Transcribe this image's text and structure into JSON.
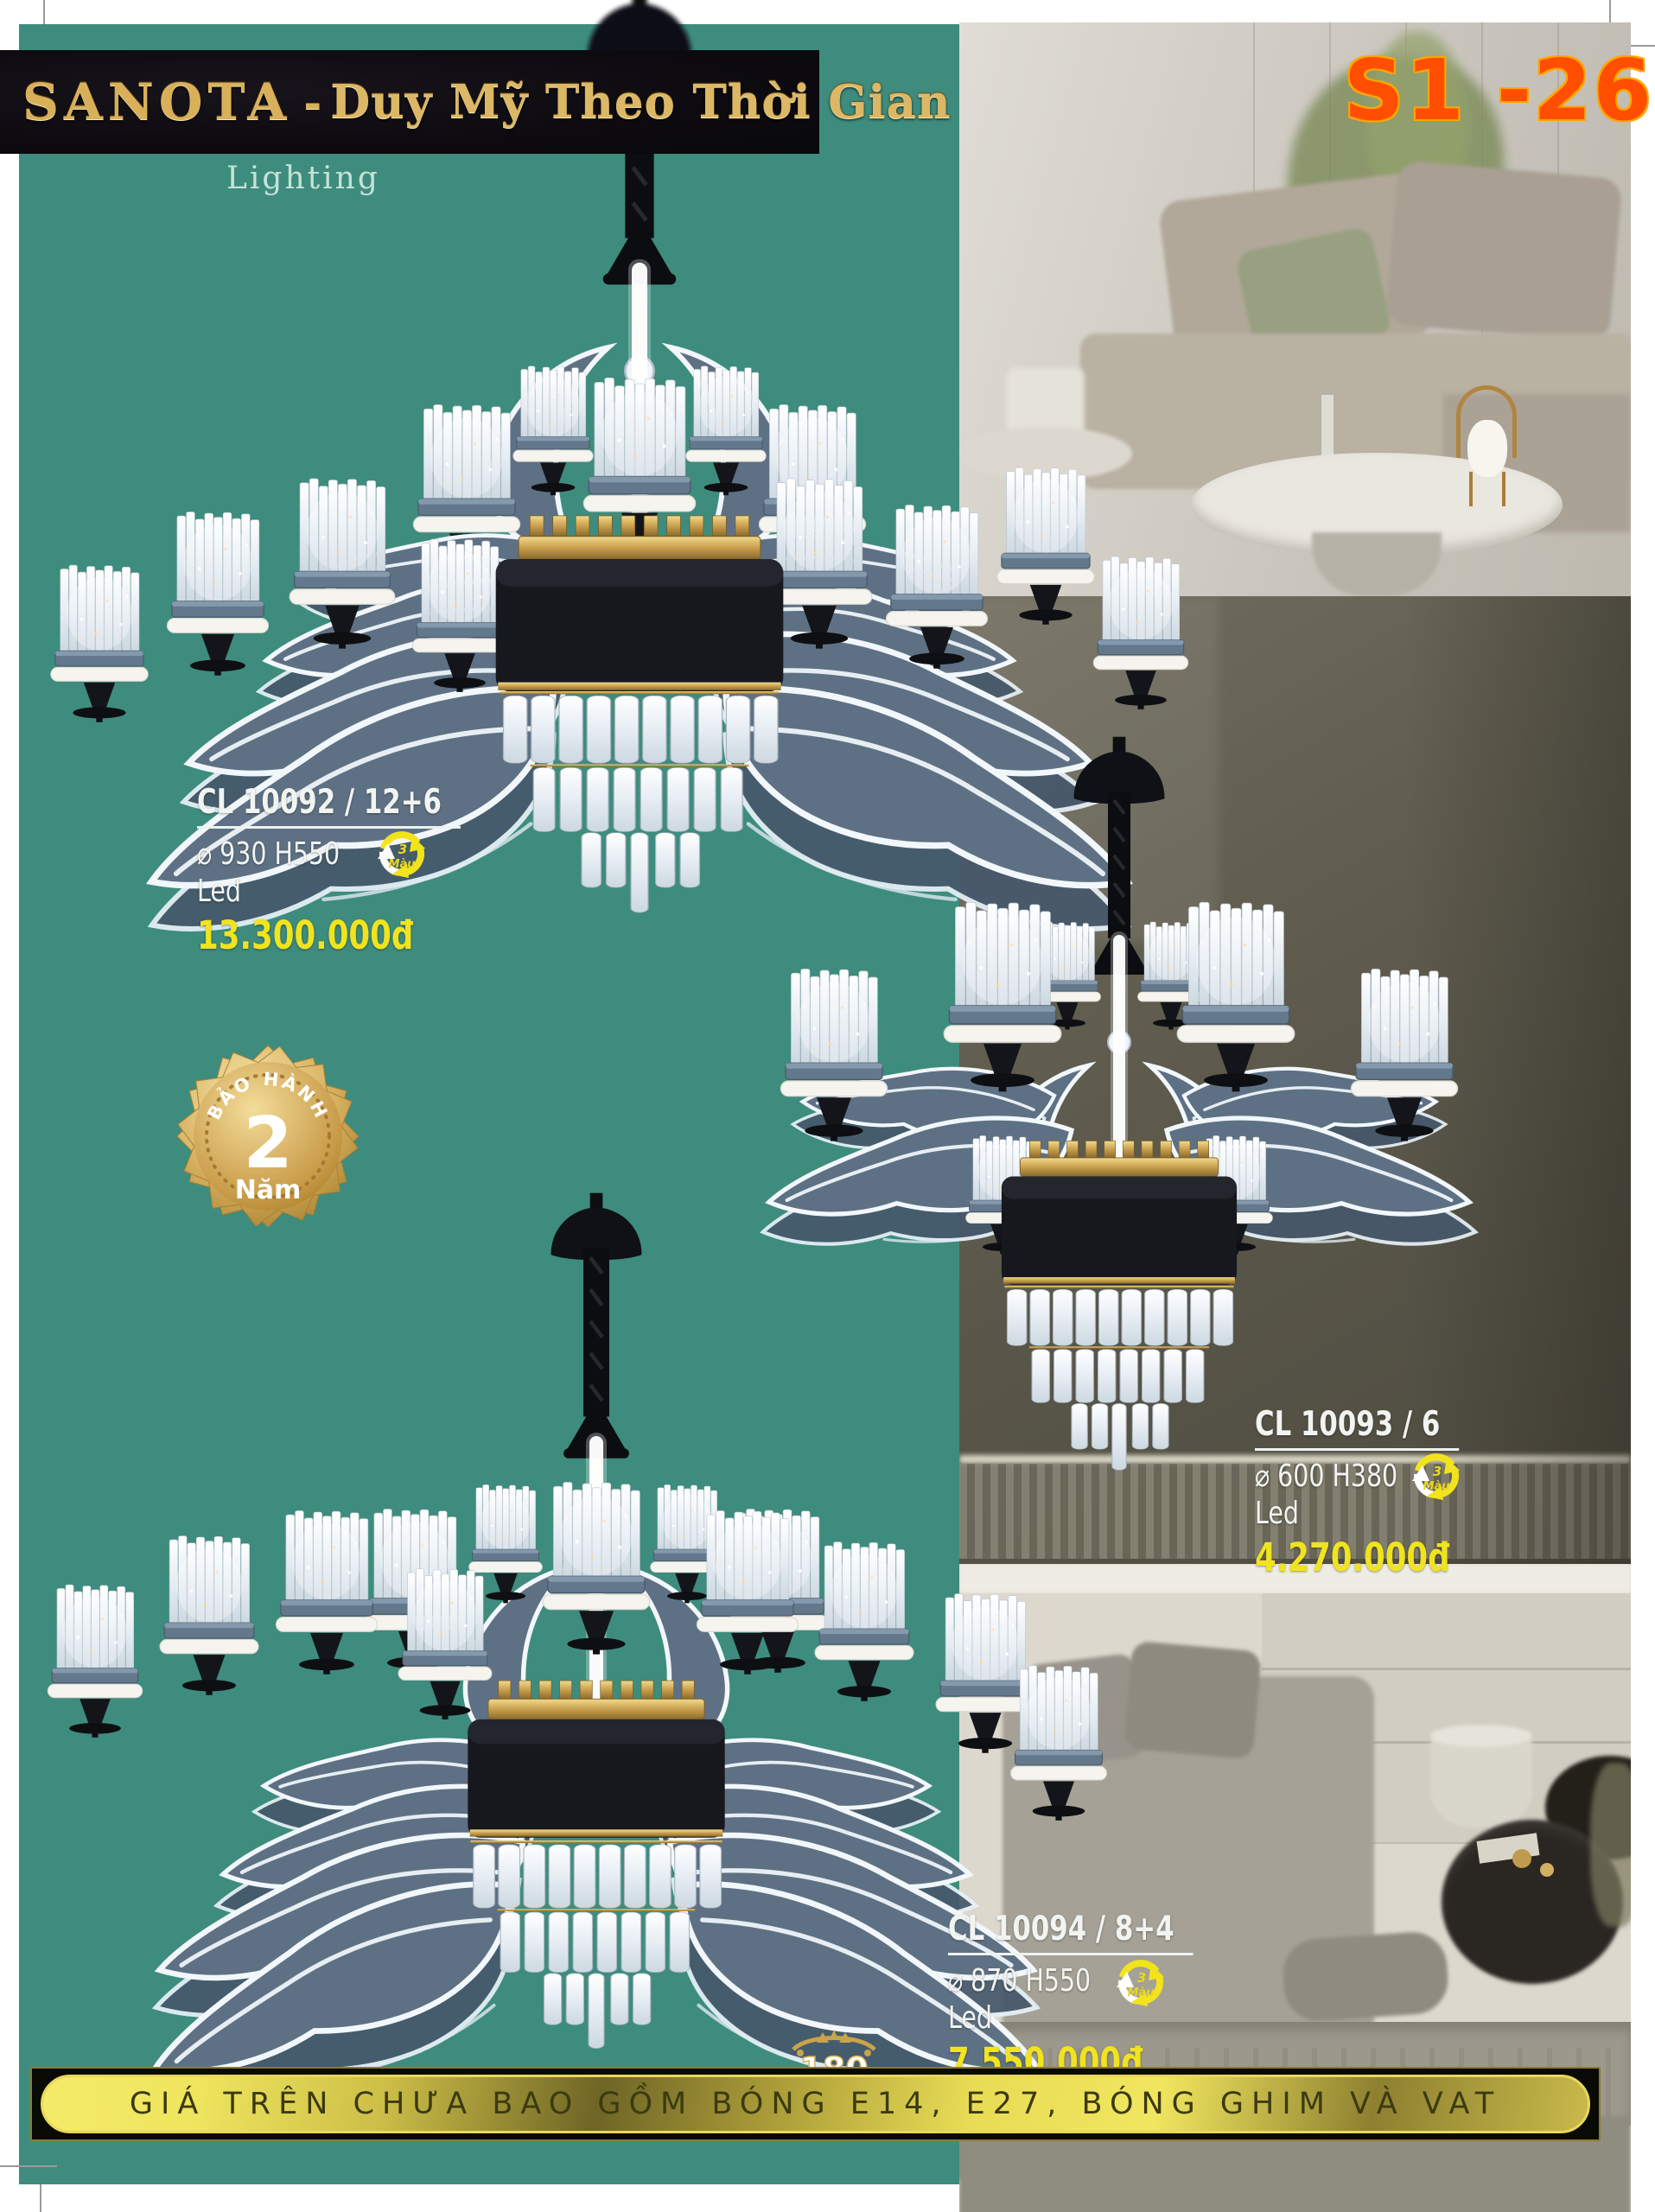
{
  "page": {
    "code": "S1 -26"
  },
  "header": {
    "brand": "SANOTA",
    "separator": "-",
    "tagline": "Duy Mỹ Theo Thời Gian",
    "sub_logo": "Lighting"
  },
  "products": [
    {
      "code": "CL 10092 / 12+6",
      "dims": "⌀ 930 H550",
      "lamp": "Led",
      "price": "13.300.000đ"
    },
    {
      "code": "CL 10093 / 6",
      "dims": "⌀ 600 H380",
      "lamp": "Led",
      "price": "4.270.000đ"
    },
    {
      "code": "CL 10094 / 8+4",
      "dims": "⌀ 870 H550",
      "lamp": "Led",
      "price": "7.550.000đ"
    }
  ],
  "color_icon": {
    "line1": "3",
    "line2": "Màu"
  },
  "warranty_badge": {
    "arc_text": "BẢO HÀNH",
    "number": "2",
    "unit": "Năm"
  },
  "partial_badge": {
    "number": "180"
  },
  "footer_banner": {
    "text": "GIÁ TRÊN CHƯA BAO GỒM BÓNG E14, E27, BÓNG GHIM VÀ VAT"
  },
  "colors": {
    "teal": "#3e8c7e",
    "price_yellow": "#f0e31f",
    "page_code_orange": "#ff4e00",
    "gold": "#d6ad55"
  }
}
